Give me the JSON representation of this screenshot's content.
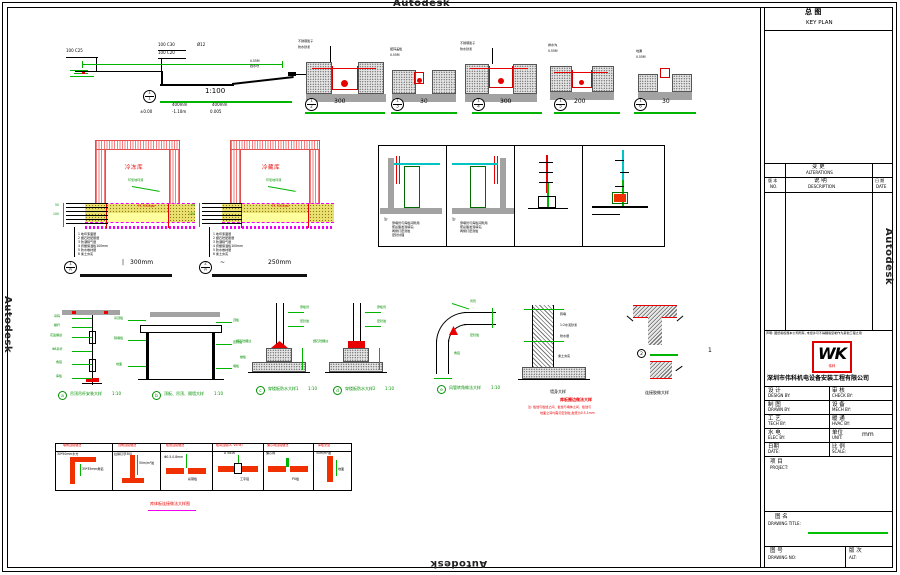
{
  "watermark": "Autodesk",
  "ramp": {
    "c25": "100  C25",
    "c30": "100  C30",
    "c20": "100  C20",
    "dia": "Ø12",
    "end1": "0.55M",
    "end2": "挡水坎",
    "bt": "1",
    "bb": "1",
    "scale": "1:100",
    "dima": "400mm",
    "dimb": "400mm",
    "lv1": "±0.00",
    "lv2": "-1.10m",
    "lv3": "0.005"
  },
  "trench_row": [
    {
      "bt": "1",
      "bb": "2",
      "dim": "300",
      "l1": "不锈钢篦子",
      "l2": "防水砂浆"
    },
    {
      "bt": "1",
      "bb": "3",
      "dim": "30",
      "l1": "镀锌盖板",
      "l2": "0.55M"
    },
    {
      "bt": "1",
      "bb": "4",
      "dim": "300",
      "l1": "不锈钢篦子",
      "l2": "防水砂浆"
    },
    {
      "bt": "1",
      "bb": "5",
      "dim": "200",
      "l1": "排水沟",
      "l2": "0.55M"
    },
    {
      "bt": "1",
      "bb": "6",
      "dim": "30",
      "l1": "地漏",
      "l2": "0.55M"
    }
  ],
  "tanks": [
    {
      "bt": "1",
      "bb": "A",
      "room": "冷冻库",
      "slab": "PC 3500psi",
      "coat": "环氧地坪漆",
      "tick": "|",
      "dim": "300mm",
      "d1": "50",
      "d2": "100",
      "layers": [
        "1  地坪漆面层",
        "2  细石砼配筋层",
        "3  防潮隔气层",
        "4  挤塑保温板100mm",
        "5  防水卷材层",
        "6  素土夯实"
      ]
    },
    {
      "bt": "2",
      "bb": "A",
      "room": "冷藏库",
      "slab": "PC 3500psi",
      "coat": "环氧地坪漆",
      "tick": "~",
      "dim": "250mm",
      "d1": "50",
      "d2": "100",
      "layers": [
        "1  地坪漆面层",
        "2  细石砼配筋层",
        "3  防潮隔气层",
        "4  挤塑保温板100mm",
        "5  防水卷材层",
        "6  素土夯实"
      ]
    }
  ],
  "panels": {
    "note_label": "注:",
    "p1_lines": [
      "穿墙管与库板间隙用",
      "聚氨酯发泡填实,",
      "两侧打密封胶",
      "密封处理"
    ],
    "p2_lines": [
      "穿墙管与库板间隙用",
      "聚氨酯发泡填实,",
      "两侧打密封胶"
    ]
  },
  "details": {
    "a": {
      "k": "a",
      "cap": "吊顶吊杆安装大样",
      "sc": "1:10",
      "labels": [
        "吊码",
        "螺杆",
        "花篮螺丝",
        "Φ8吊杆",
        "角铝",
        "库板"
      ]
    },
    "b": {
      "k": "b",
      "cap": "顶板、吊顶、隔墙大样",
      "sc": "1:10",
      "labels_l": [
        "吊顶板",
        "隔墙板",
        "地面"
      ],
      "labels_r": [
        "顶板",
        "密封胶",
        "墙板"
      ]
    },
    "c": {
      "k": "c",
      "cap": "穿楼板防水大样1",
      "sc": "1:10",
      "labels": [
        "穿板管",
        "密封胶",
        "细石砼翻边",
        "楼板"
      ]
    },
    "d": {
      "k": "d",
      "cap": "穿楼板防水大样2",
      "sc": "1:10",
      "labels": [
        "穿板管",
        "密封胶",
        "细石砼翻边"
      ]
    },
    "e": {
      "k": "e",
      "cap": "风管转角做法大样",
      "sc": "1:10",
      "labels": [
        "风管",
        "密封胶",
        "角铝"
      ]
    },
    "wall": {
      "cap": "墙身大样",
      "labels": [
        "砖墙",
        "1:2水泥砂浆",
        "防水层",
        "素土夯实"
      ]
    },
    "t": {
      "num": "2",
      "side": "1",
      "cap": "连接胶做大样"
    },
    "note": {
      "t": "库板圈边做法大样",
      "l1": "注: 板缝与板缝之间、板缝与墙体之间、板缝与",
      "l2": "地面之间均需打密封胶,胶宽为0.5-1mm"
    }
  },
  "strip": {
    "cells": [
      {
        "h": "墙角连接做法",
        "a": "30*50mm木方",
        "b": "35*35mm角铝"
      },
      {
        "h": "顶角连接做法",
        "a": "拉铆钉@300",
        "b": "50m/m²胶"
      },
      {
        "h": "板缝连接做法",
        "a": "Φ0.5-0.8mm",
        "b": "彩钢板"
      },
      {
        "h": "板间连接(A. VIEW)",
        "a": "A  VIEW",
        "b": "工字铝"
      },
      {
        "h": "偏心钩连接做法",
        "a": "偏心钩",
        "b": "PU板"
      },
      {
        "h": "库板安装",
        "a": "50m/m²胶",
        "b": "地面"
      }
    ],
    "cap": "库体板连接做法大样图"
  },
  "title_block": {
    "key_plan_cn": "总    图",
    "key_plan_en": "KEY PLAN",
    "alt_cn": "变    更",
    "alt_en": "ALTERATIONS",
    "no_cn": "版 本",
    "no_en": "NO.",
    "desc_cn": "说    明",
    "desc_en": "DESCRIPTION",
    "date_cn": "日 期",
    "date_en": "DATE",
    "disclaimer": "声明: 图纸版权属本公司所有, 未经许可不得翻版复制作为其他工程之用",
    "logo_text": "WK",
    "logo_sub": "伟科",
    "company": "深圳市伟科机电设备安装工程有限公司",
    "rows": [
      {
        "lcn": "设    计",
        "len": "DESIGN BY:",
        "rcn": "审    核",
        "ren": "CHECK BY:",
        "rval": ""
      },
      {
        "lcn": "制    图",
        "len": "DRAWN BY:",
        "rcn": "设    备",
        "ren": "MECH BY:",
        "rval": ""
      },
      {
        "lcn": "工    艺",
        "len": "TECH BY:",
        "rcn": "暖    通",
        "ren": "HVAC BY:",
        "rval": ""
      },
      {
        "lcn": "水    电",
        "len": "ELEC BY:",
        "rcn": "单位",
        "ren": "UNIT:",
        "rval": "mm"
      },
      {
        "lcn": "日期",
        "len": "DATE:",
        "rcn": "比 例",
        "ren": "SCALE:",
        "rval": ""
      }
    ],
    "project_cn": "项    目",
    "project_en": "PROJECT:",
    "title_cn": "图        名",
    "title_en": "DRAWING TITLE:",
    "no2_cn": "图    号",
    "no2_en": "DRAWING NO:",
    "rev_cn": "版 次",
    "rev_en": "ALT:"
  }
}
